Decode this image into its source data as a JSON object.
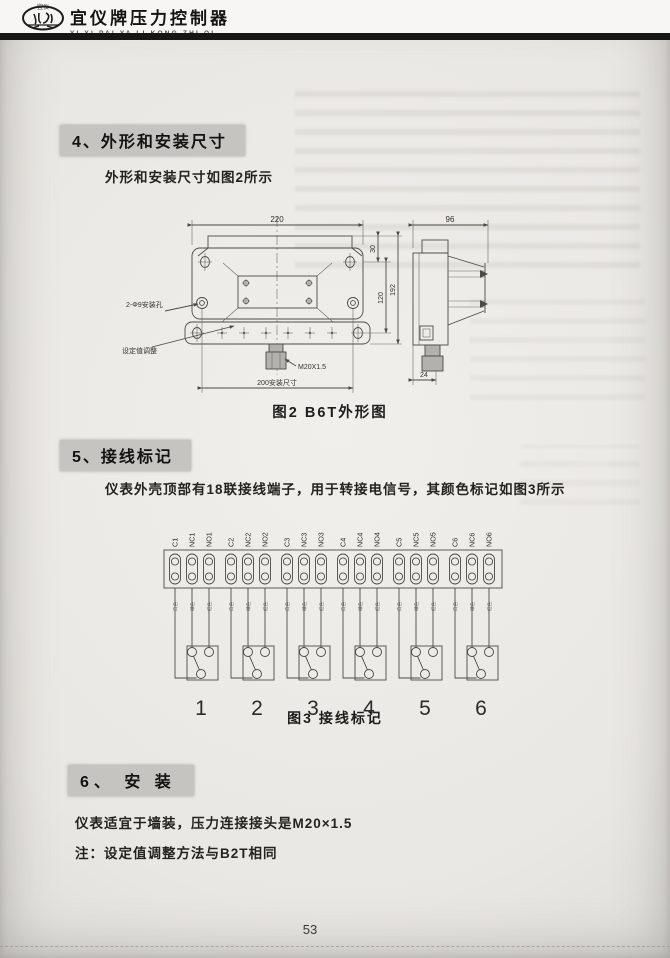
{
  "header": {
    "logo_text": "宜仪",
    "brand_title": "宜仪牌压力控制器",
    "brand_subtitle": "YI YI PAI YA LI KONG ZHI QI"
  },
  "sections": {
    "s4": {
      "heading": "4、外形和安装尺寸",
      "body": "外形和安装尺寸如图2所示"
    },
    "s5": {
      "heading": "5、接线标记",
      "body": "仪表外壳顶部有18联接线端子，用于转接电信号，其颜色标记如图3所示"
    },
    "s6": {
      "heading": "6、 安 装",
      "body1": "仪表适宜于墙装，压力连接接头是M20×1.5",
      "body2": "注：设定值调整方法与B2T相同"
    }
  },
  "figure2": {
    "caption": "图2 B6T外形图",
    "dim_width": "220",
    "dim_top": "30",
    "dim_mid_height": "120",
    "dim_height": "192",
    "dim_depth": "96",
    "dim_bottom": "24",
    "dim_mount": "200安装尺寸",
    "thread_label": "M20X1.5",
    "mount_hole_label": "2-Φ9安装孔",
    "setpoint_label": "设定值调整"
  },
  "figure3": {
    "caption": "图3 接线标记",
    "terminals": [
      "C1",
      "NC1",
      "NO1",
      "C2",
      "NC2",
      "NO2",
      "C3",
      "NC3",
      "NO3",
      "C4",
      "NC4",
      "NO4",
      "C5",
      "NC5",
      "NO5",
      "C6",
      "NC6",
      "NO6"
    ],
    "wire_marks": [
      "白色",
      "绿色",
      "红色"
    ],
    "groups": [
      "1",
      "2",
      "3",
      "4",
      "5",
      "6"
    ]
  },
  "footer": {
    "page_number": "53"
  }
}
